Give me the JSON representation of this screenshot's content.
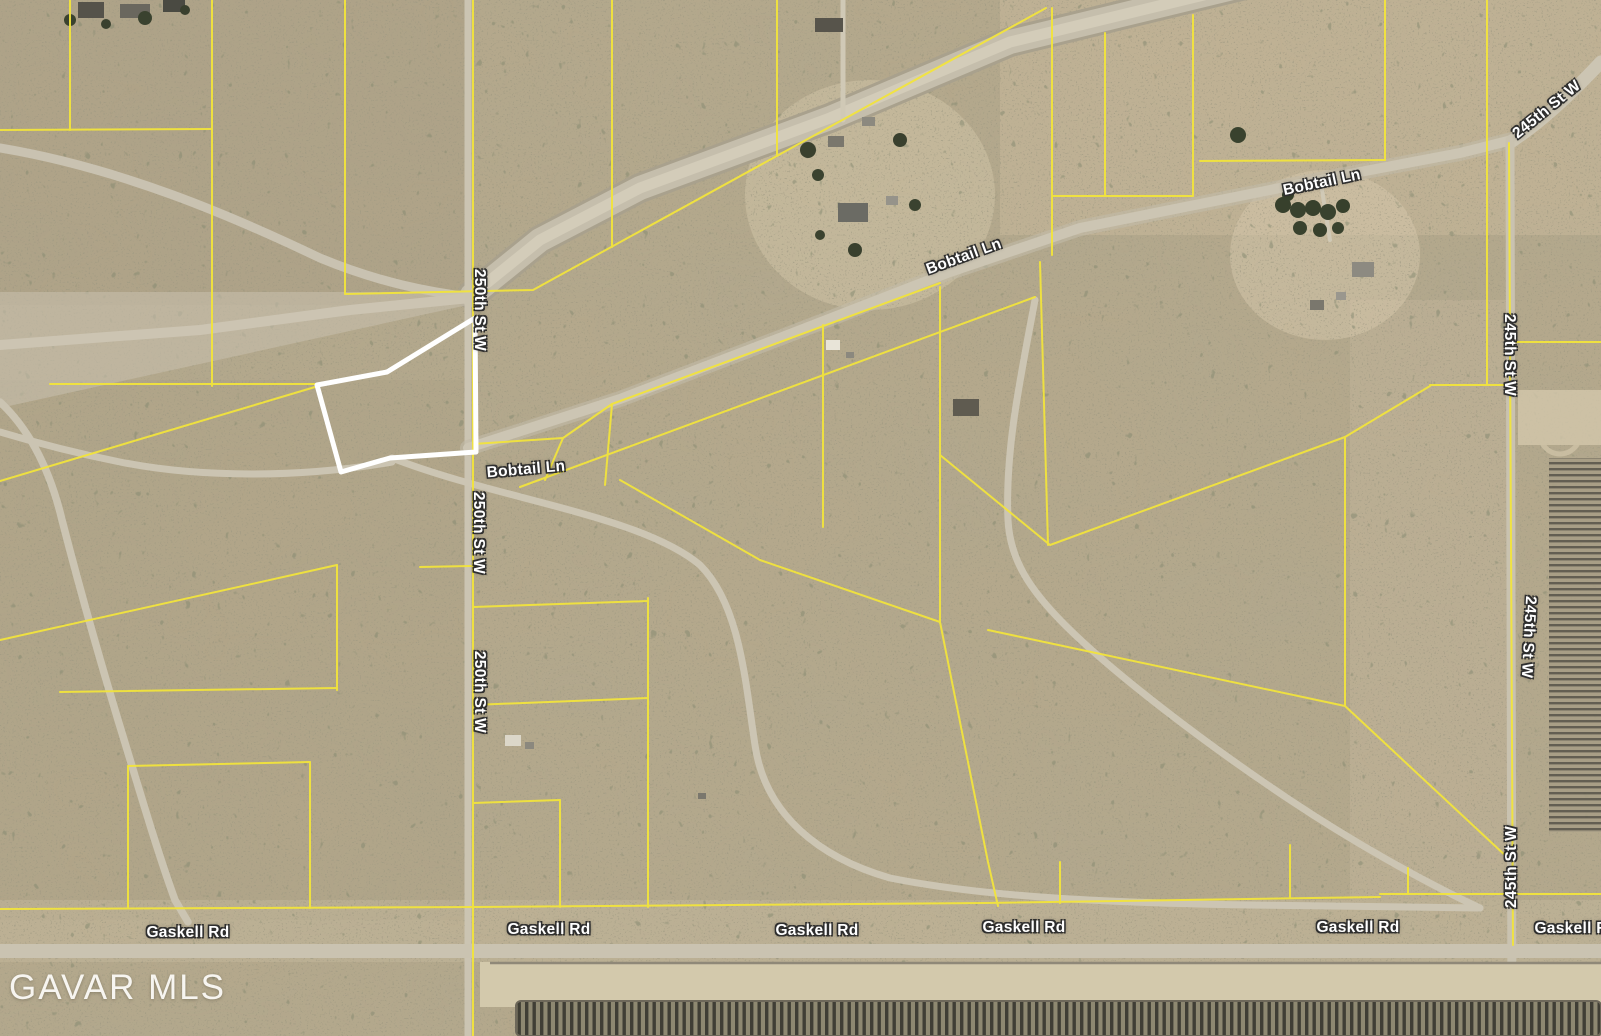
{
  "watermark": "GAVAR MLS",
  "map": {
    "description": "Satellite aerial parcel map with lot boundary lines and subject parcel outlined in white",
    "colors": {
      "parcel_line": "#f2e43c",
      "subject_parcel_outline": "#ffffff",
      "label_text": "#ffffff",
      "label_halo": "#2e2e2e",
      "desert_base": "#b4a88c",
      "road_surface": "#c9c2b0"
    },
    "road_names": [
      "250th St W",
      "245th St W",
      "Bobtail Ln",
      "Gaskell Rd"
    ],
    "road_labels": [
      {
        "text": "250th St W",
        "x": 479,
        "y": 310,
        "rot": 90
      },
      {
        "text": "250th St W",
        "x": 478,
        "y": 533,
        "rot": 90
      },
      {
        "text": "250th St W",
        "x": 479,
        "y": 692,
        "rot": 90
      },
      {
        "text": "245th St W",
        "x": 1547,
        "y": 110,
        "rot": -39
      },
      {
        "text": "245th St W",
        "x": 1509,
        "y": 355,
        "rot": 90
      },
      {
        "text": "245th St W",
        "x": 1528,
        "y": 637,
        "rot": 93
      },
      {
        "text": "245th St W",
        "x": 1512,
        "y": 867,
        "rot": -90
      },
      {
        "text": "Bobtail Ln",
        "x": 526,
        "y": 470,
        "rot": -5
      },
      {
        "text": "Bobtail Ln",
        "x": 964,
        "y": 257,
        "rot": -20
      },
      {
        "text": "Bobtail Ln",
        "x": 1322,
        "y": 183,
        "rot": -12
      },
      {
        "text": "Gaskell Rd",
        "x": 188,
        "y": 933,
        "rot": 0
      },
      {
        "text": "Gaskell Rd",
        "x": 549,
        "y": 930,
        "rot": 0
      },
      {
        "text": "Gaskell Rd",
        "x": 817,
        "y": 931,
        "rot": 0
      },
      {
        "text": "Gaskell Rd",
        "x": 1024,
        "y": 928,
        "rot": 0
      },
      {
        "text": "Gaskell Rd",
        "x": 1358,
        "y": 928,
        "rot": 0
      },
      {
        "text": "Gaskell Rd",
        "x": 1576,
        "y": 929,
        "rot": 0
      }
    ]
  }
}
